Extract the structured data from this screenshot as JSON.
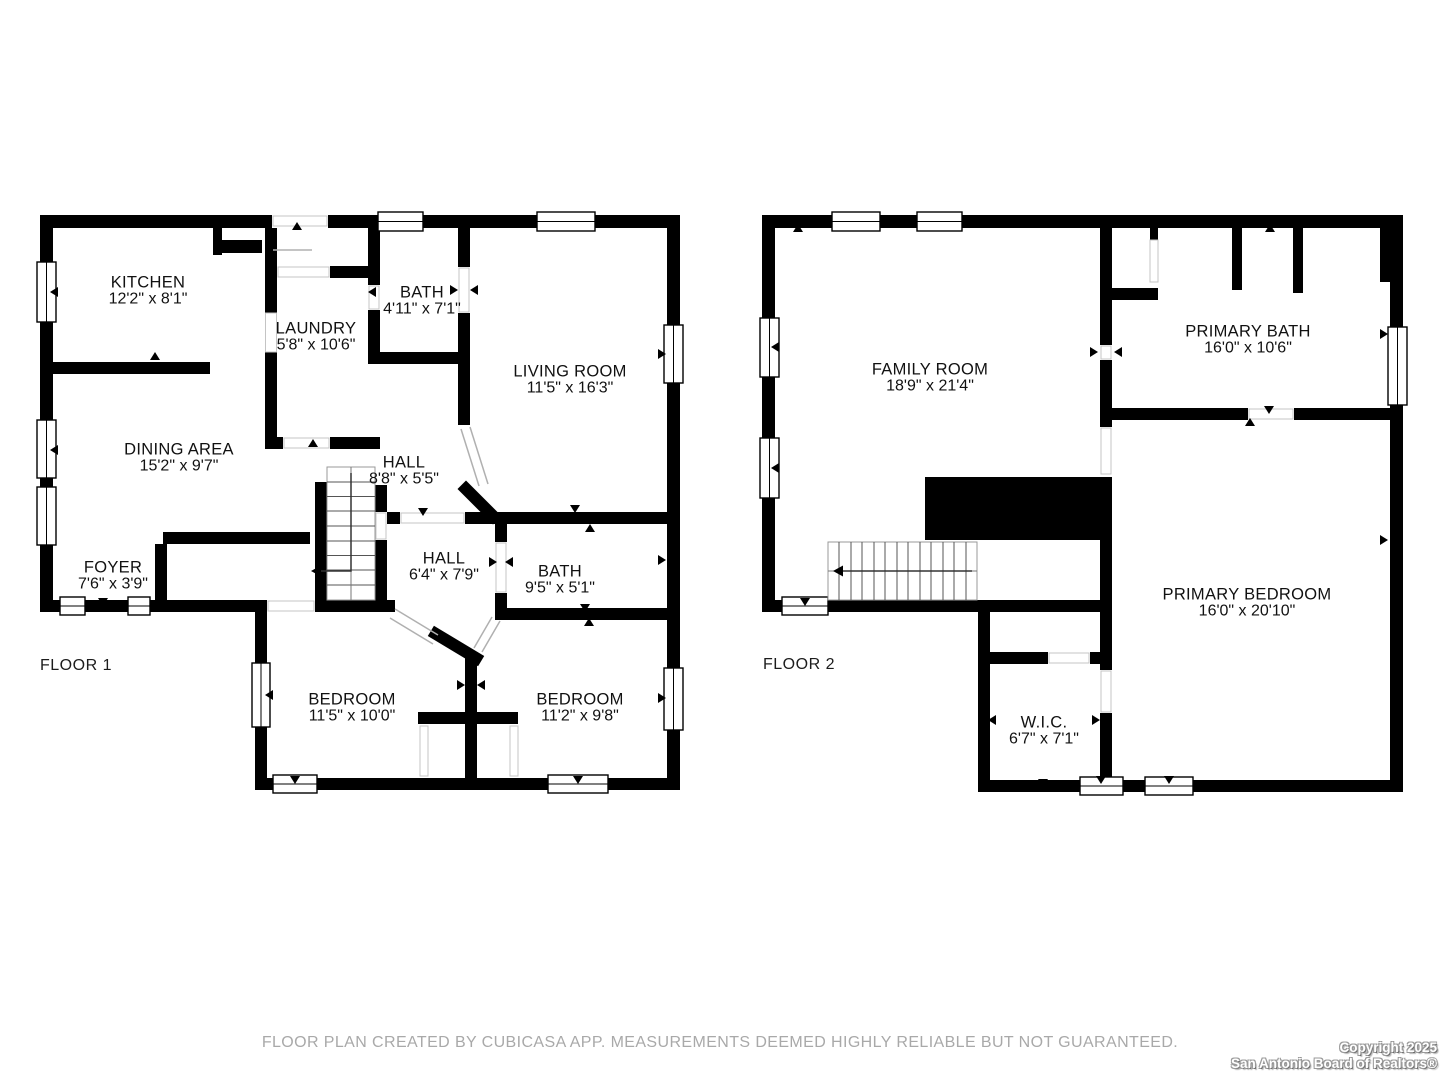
{
  "plan": {
    "source_note": "floor plan drawing",
    "floors": [
      {
        "name": "FLOOR 1",
        "rooms": [
          {
            "name": "KITCHEN",
            "dims": "12'2\" x 8'1\"",
            "cx": 148,
            "cy": 283
          },
          {
            "name": "LAUNDRY",
            "dims": "5'8\" x 10'6\"",
            "cx": 316,
            "cy": 329
          },
          {
            "name": "BATH",
            "dims": "4'11\" x 7'1\"",
            "cx": 422,
            "cy": 293
          },
          {
            "name": "LIVING ROOM",
            "dims": "11'5\" x 16'3\"",
            "cx": 570,
            "cy": 372
          },
          {
            "name": "DINING AREA",
            "dims": "15'2\" x 9'7\"",
            "cx": 179,
            "cy": 450
          },
          {
            "name": "HALL",
            "dims": "8'8\" x 5'5\"",
            "cx": 404,
            "cy": 463
          },
          {
            "name": "FOYER",
            "dims": "7'6\" x 3'9\"",
            "cx": 113,
            "cy": 568
          },
          {
            "name": "HALL",
            "dims": "6'4\" x 7'9\"",
            "cx": 444,
            "cy": 559
          },
          {
            "name": "BATH",
            "dims": "9'5\" x 5'1\"",
            "cx": 560,
            "cy": 572
          },
          {
            "name": "BEDROOM",
            "dims": "11'5\" x 10'0\"",
            "cx": 352,
            "cy": 700
          },
          {
            "name": "BEDROOM",
            "dims": "11'2\" x 9'8\"",
            "cx": 580,
            "cy": 700
          }
        ]
      },
      {
        "name": "FLOOR 2",
        "rooms": [
          {
            "name": "FAMILY ROOM",
            "dims": "18'9\" x 21'4\"",
            "cx": 930,
            "cy": 370
          },
          {
            "name": "PRIMARY BATH",
            "dims": "16'0\" x 10'6\"",
            "cx": 1248,
            "cy": 332
          },
          {
            "name": "PRIMARY BEDROOM",
            "dims": "16'0\" x 20'10\"",
            "cx": 1247,
            "cy": 595
          },
          {
            "name": "W.I.C.",
            "dims": "6'7\" x 7'1\"",
            "cx": 1044,
            "cy": 723
          }
        ]
      }
    ]
  },
  "footer": {
    "disclaimer": "FLOOR PLAN CREATED BY CUBICASA APP. MEASUREMENTS DEEMED HIGHLY RELIABLE BUT NOT GUARANTEED.",
    "copyright_line1": "Copyright 2025",
    "copyright_line2": "San Antonio Board of Realtors®"
  },
  "colors": {
    "wall": "#000000",
    "label_text": "#111111",
    "disclaimer_text": "#a9a9a9",
    "door_line": "#c4c4c4"
  }
}
